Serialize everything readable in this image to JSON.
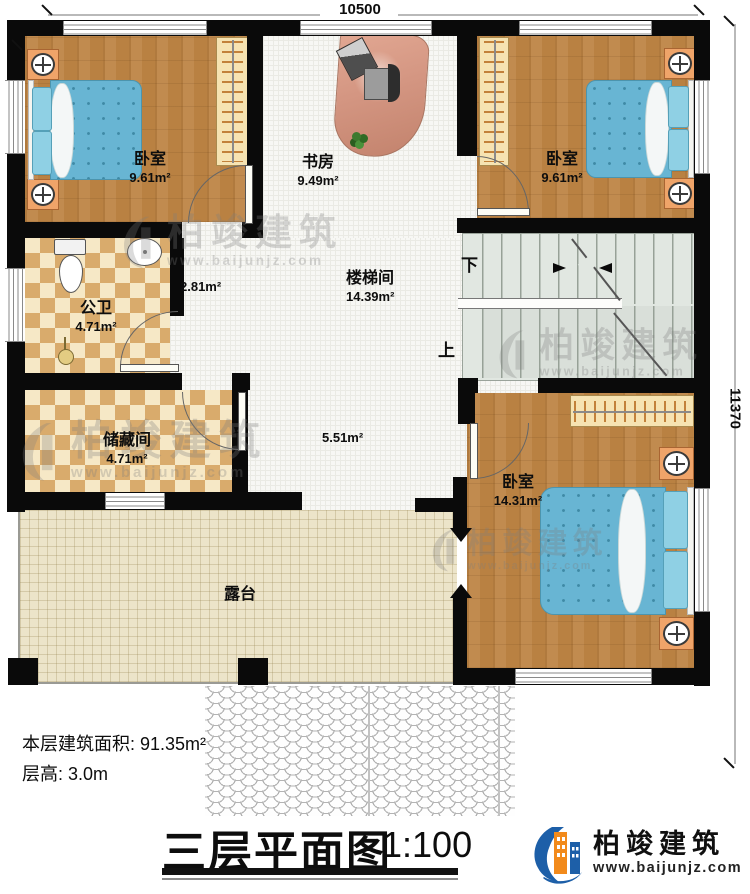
{
  "page": {
    "dim_top": "10500",
    "dim_right": "11370",
    "area_note": "本层建筑面积: 91.35m²",
    "height_note": "层高: 3.0m",
    "title": "三层平面图",
    "scale": "1:100"
  },
  "rooms": {
    "bedroom_tl": {
      "name": "卧室",
      "area": "9.61m²"
    },
    "study": {
      "name": "书房",
      "area": "9.49m²"
    },
    "bedroom_tr": {
      "name": "卧室",
      "area": "9.61m²"
    },
    "bathroom": {
      "name": "公卫",
      "area": "4.71m²"
    },
    "hall_small": {
      "area": "2.81m²"
    },
    "storage": {
      "name": "储藏间",
      "area": "4.71m²"
    },
    "stairwell": {
      "name": "楼梯间",
      "area": "14.39m²"
    },
    "corridor": {
      "area": "5.51m²"
    },
    "bedroom_br": {
      "name": "卧室",
      "area": "14.31m²"
    },
    "terrace": {
      "name": "露台"
    }
  },
  "stairs": {
    "down_label": "下",
    "up_label": "上"
  },
  "watermark": {
    "brand": "柏竣建筑",
    "site": "www.baijunjz.com"
  },
  "logo": {
    "brand": "柏竣建筑",
    "site": "www.baijunjz.com"
  },
  "colors": {
    "wall": "#0a0a0a",
    "wood": "#b98142",
    "bed_blue": "#68b5d3",
    "tile_light": "#f6e8c6",
    "tile_dark": "#d9ab6c",
    "terrace_floor": "#ece4c9",
    "stair_floor": "#e1e7e1",
    "logo_blue": "#1d5fa8",
    "logo_orange": "#f28a1b"
  }
}
